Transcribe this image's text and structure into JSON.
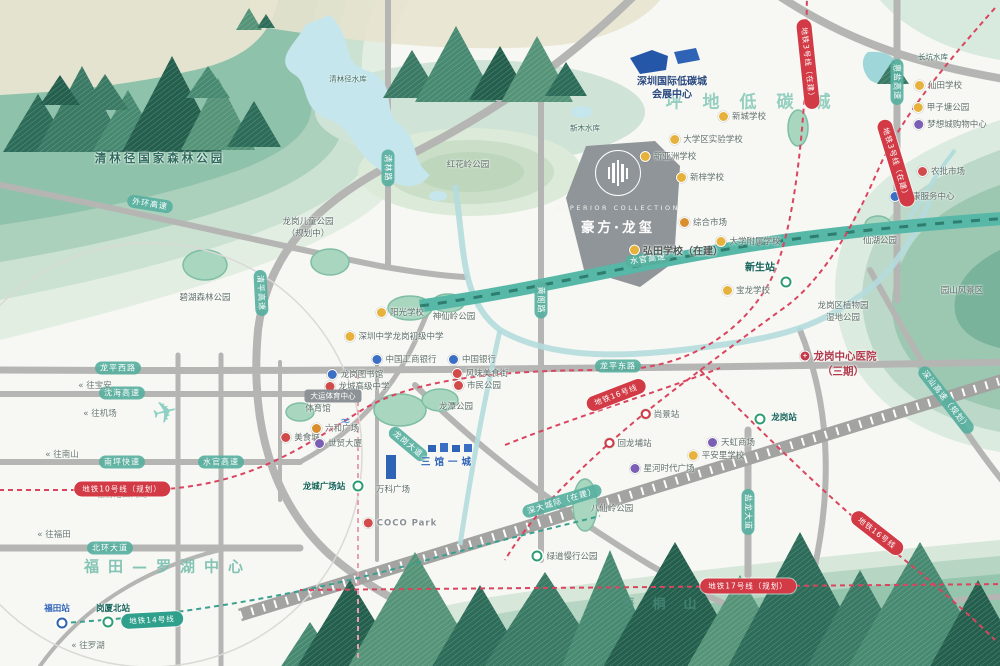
{
  "project": {
    "name_en": "SUPERIOR COLLECTION",
    "name_cn": "豪方·龙玺"
  },
  "colors": {
    "accent_red": "#d23a45",
    "accent_teal": "#2fa08c",
    "road_gray": "#b5b6b4",
    "park_green": "#8fc2ab"
  },
  "area_texts": [
    {
      "t": "坪地低碳城",
      "x": 758,
      "y": 100,
      "cls": "a-lowcarbon"
    },
    {
      "t": "福田—罗湖中心",
      "x": 168,
      "y": 566,
      "cls": "a-futian"
    },
    {
      "t": "梧桐山",
      "x": 668,
      "y": 603,
      "cls": "a-wutong"
    }
  ],
  "pois": [
    {
      "t": "清林径国家森林公园",
      "x": 160,
      "y": 158,
      "cls": "parkname"
    },
    {
      "t": "清林径水库",
      "x": 348,
      "y": 79,
      "cls": "water"
    },
    {
      "t": "新木水库",
      "x": 585,
      "y": 128,
      "cls": "water"
    },
    {
      "t": "长坑水库",
      "x": 933,
      "y": 57,
      "cls": "water"
    },
    {
      "t": "深圳国际低碳城",
      "x": 672,
      "y": 80,
      "cls": "navy"
    },
    {
      "t": "会展中心",
      "x": 672,
      "y": 93,
      "cls": "navy"
    },
    {
      "t": "红花岭公园",
      "x": 468,
      "y": 164
    },
    {
      "t": "龙岗儿童公园",
      "x": 308,
      "y": 221
    },
    {
      "t": "（规划中）",
      "x": 308,
      "y": 233
    },
    {
      "t": "碧湖森林公园",
      "x": 205,
      "y": 297
    },
    {
      "t": "新城学校",
      "x": 742,
      "y": 116,
      "ic": "sch"
    },
    {
      "t": "大学区实验学校",
      "x": 706,
      "y": 139,
      "ic": "sch"
    },
    {
      "t": "新亚洲学校",
      "x": 668,
      "y": 156,
      "ic": "sch"
    },
    {
      "t": "新梓学校",
      "x": 700,
      "y": 177,
      "ic": "sch"
    },
    {
      "t": "综合市场",
      "x": 703,
      "y": 222,
      "ic": "mkt"
    },
    {
      "t": "弘田学校（在建）",
      "x": 676,
      "y": 250,
      "ic": "sch",
      "cls": "bold"
    },
    {
      "t": "大学附属学校",
      "x": 748,
      "y": 241,
      "ic": "sch"
    },
    {
      "t": "宝龙学校",
      "x": 746,
      "y": 290,
      "ic": "sch"
    },
    {
      "t": "新生站",
      "x": 760,
      "y": 266,
      "cls": "stn-label"
    },
    {
      "t": "龙岗区植物园",
      "x": 843,
      "y": 305
    },
    {
      "t": "湿地公园",
      "x": 843,
      "y": 317
    },
    {
      "t": "园山风景区",
      "x": 962,
      "y": 290
    },
    {
      "t": "仙田学校",
      "x": 938,
      "y": 85,
      "ic": "sch"
    },
    {
      "t": "甲子塘公园",
      "x": 941,
      "y": 107,
      "ic": "sch"
    },
    {
      "t": "梦想城购物中心",
      "x": 950,
      "y": 124,
      "ic": "shp"
    },
    {
      "t": "农批市场",
      "x": 941,
      "y": 171,
      "ic": "fd"
    },
    {
      "t": "社康服务中心",
      "x": 922,
      "y": 196,
      "ic": "bnk"
    },
    {
      "t": "仙湖公园",
      "x": 880,
      "y": 240
    },
    {
      "t": "龙岗中心医院",
      "x": 838,
      "y": 356,
      "ic": "hos",
      "cls": "hosp"
    },
    {
      "t": "（三期）",
      "x": 843,
      "y": 371,
      "cls": "hosp"
    },
    {
      "t": "阳光学校",
      "x": 400,
      "y": 312,
      "ic": "sch"
    },
    {
      "t": "神仙岭公园",
      "x": 454,
      "y": 316
    },
    {
      "t": "深圳中学龙岗初级中学",
      "x": 394,
      "y": 336,
      "ic": "sch"
    },
    {
      "t": "中国工商银行",
      "x": 404,
      "y": 359,
      "ic": "bnk"
    },
    {
      "t": "中国银行",
      "x": 472,
      "y": 359,
      "ic": "bnk"
    },
    {
      "t": "龙岗图书馆",
      "x": 355,
      "y": 374,
      "ic": "bnk"
    },
    {
      "t": "龙城高级中学",
      "x": 357,
      "y": 386,
      "ic": "fd"
    },
    {
      "t": "风味美食街",
      "x": 480,
      "y": 373,
      "ic": "fd"
    },
    {
      "t": "市民公园",
      "x": 477,
      "y": 385,
      "ic": "fd"
    },
    {
      "t": "大运体育中心",
      "x": 333,
      "y": 396,
      "cls": "badge"
    },
    {
      "t": "体育馆",
      "x": 318,
      "y": 408
    },
    {
      "t": "龙潭公园",
      "x": 456,
      "y": 406
    },
    {
      "t": "美食城",
      "x": 300,
      "y": 437,
      "ic": "fd"
    },
    {
      "t": "六和广场",
      "x": 335,
      "y": 428,
      "ic": "mkt"
    },
    {
      "t": "世贸大厦",
      "x": 338,
      "y": 443,
      "ic": "shp"
    },
    {
      "t": "龙城广场站",
      "x": 324,
      "y": 486,
      "cls": "stn-label-sm"
    },
    {
      "t": "三馆一城",
      "x": 448,
      "y": 461,
      "cls": "blue-sp"
    },
    {
      "t": "万科广场",
      "x": 393,
      "y": 489
    },
    {
      "t": "COCO Park",
      "x": 400,
      "y": 523,
      "ic": "fd",
      "cls": "coco"
    },
    {
      "t": "星河时代广场",
      "x": 662,
      "y": 468,
      "ic": "shp"
    },
    {
      "t": "天虹商场",
      "x": 731,
      "y": 442,
      "ic": "shp"
    },
    {
      "t": "平安里学校",
      "x": 716,
      "y": 455,
      "ic": "sch"
    },
    {
      "t": "尚景站",
      "x": 660,
      "y": 414,
      "ic": "stn-r"
    },
    {
      "t": "回龙埔站",
      "x": 628,
      "y": 443,
      "ic": "stn-r"
    },
    {
      "t": "八仙岭公园",
      "x": 612,
      "y": 508
    },
    {
      "t": "绿道慢行公园",
      "x": 572,
      "y": 556
    },
    {
      "t": "龙岗站",
      "x": 784,
      "y": 417,
      "cls": "stn-label-sm"
    },
    {
      "t": "岗厦北站",
      "x": 113,
      "y": 608,
      "cls": "stn-label-sm"
    },
    {
      "t": "福田站",
      "x": 57,
      "y": 608,
      "cls": "stn-label-sm blue"
    }
  ],
  "stations": [
    {
      "x": 786,
      "y": 282,
      "k": "g"
    },
    {
      "x": 358,
      "y": 486,
      "k": "g"
    },
    {
      "x": 537,
      "y": 556,
      "k": "g"
    },
    {
      "x": 760,
      "y": 419,
      "k": "g"
    },
    {
      "x": 108,
      "y": 622,
      "k": "g"
    },
    {
      "x": 62,
      "y": 623,
      "k": "b"
    }
  ],
  "pills": [
    {
      "t": "地铁10号线（规划）",
      "x": 122,
      "y": 489,
      "r": 0
    },
    {
      "t": "地铁3号线（在建）",
      "x": 808,
      "y": 64,
      "r": 84
    },
    {
      "t": "地铁3号线（在建）",
      "x": 896,
      "y": 163,
      "r": 73
    },
    {
      "t": "地铁16号线",
      "x": 616,
      "y": 395,
      "r": -21
    },
    {
      "t": "地铁16号线",
      "x": 877,
      "y": 533,
      "r": 38
    },
    {
      "t": "地铁17号线（规划）",
      "x": 748,
      "y": 586,
      "r": 0
    },
    {
      "t": "地铁14号线",
      "x": 152,
      "y": 620,
      "r": -3,
      "teal": true
    }
  ],
  "road_labels": [
    {
      "t": "龙平西路",
      "x": 118,
      "y": 368,
      "r": 0
    },
    {
      "t": "沈海高速",
      "x": 122,
      "y": 393,
      "r": 0
    },
    {
      "t": "南坪快速",
      "x": 122,
      "y": 462,
      "r": 0
    },
    {
      "t": "水官高速",
      "x": 221,
      "y": 462,
      "r": 0
    },
    {
      "t": "北环大道",
      "x": 110,
      "y": 548,
      "r": 0
    },
    {
      "t": "龙平东路",
      "x": 618,
      "y": 366,
      "r": 0
    },
    {
      "t": "水官高速",
      "x": 648,
      "y": 259,
      "r": -8
    },
    {
      "t": "龙岗大道",
      "x": 408,
      "y": 444,
      "r": 40
    },
    {
      "t": "盐龙大道",
      "x": 748,
      "y": 512,
      "r": 90
    },
    {
      "t": "黄阁路",
      "x": 541,
      "y": 300,
      "r": 90
    },
    {
      "t": "惠盐高速",
      "x": 897,
      "y": 82,
      "r": 90
    },
    {
      "t": "深汕高速（规划）",
      "x": 946,
      "y": 400,
      "r": 52
    },
    {
      "t": "外环高速",
      "x": 150,
      "y": 204,
      "r": 9
    },
    {
      "t": "清林路",
      "x": 388,
      "y": 168,
      "r": 90
    },
    {
      "t": "清平高速",
      "x": 261,
      "y": 293,
      "r": 87
    },
    {
      "t": "深大城际（在建）",
      "x": 562,
      "y": 501,
      "r": -17
    }
  ],
  "arrows": [
    {
      "t": "« 往宝安",
      "x": 95,
      "y": 385
    },
    {
      "t": "« 往机场",
      "x": 100,
      "y": 413
    },
    {
      "t": "« 往南山",
      "x": 62,
      "y": 454
    },
    {
      "t": "« 往香港西九龙",
      "x": 118,
      "y": 494
    },
    {
      "t": "« 往福田",
      "x": 54,
      "y": 534
    },
    {
      "t": "« 往罗湖",
      "x": 88,
      "y": 645
    }
  ]
}
